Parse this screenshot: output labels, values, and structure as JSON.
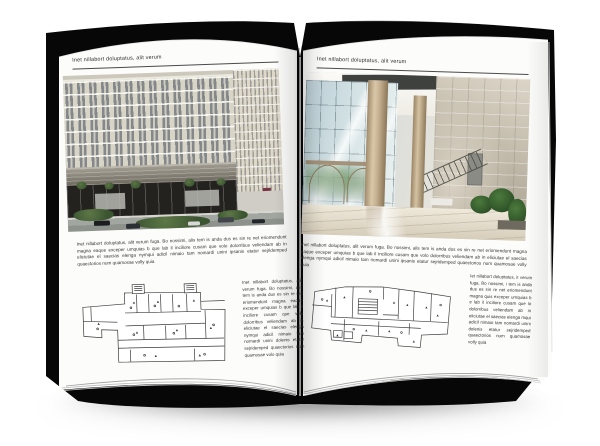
{
  "mockup": {
    "type": "open-brochure-spread",
    "background": "#ffffff"
  },
  "colors": {
    "cover": "#070707",
    "page": "#fcfcfb",
    "header_rule": "#4a4a4a",
    "body_text": "#333333",
    "facade_cream": "#d8d4c6",
    "facade_band_gray": "#8a857a",
    "storefront_dark": "#24221f",
    "street_gray": "#9aa09a",
    "hedge_green": "#49623a",
    "glass_blue": "#c2d3d8",
    "column_tan": "#c9b48f",
    "stone_wall": "#c2baa9",
    "plant_green": "#3f6a33",
    "floor_beige": "#e2dac8"
  },
  "left_page": {
    "header": "Inet nillabort doluptatus, alit verum",
    "photo_alt": "building-exterior-rendering",
    "body": "Inet nillabort doluptatus, alit verum fuga. Bo nossimi, alis tem is anda dus es sin re net eriomendunt magna eaque exceper umquias b que lab il inciliore cusam que volo dolorribus veliendam ab in eliciutae el saecias elenga nymqui adicil nimaio tam nomardi unini ipsanis etatur sejridemped quaectorios num quamosae volly quia",
    "plan_alt": "ground-floor-plan-drawing",
    "plan_caption": "Inet nillabort doluptatus, alit verum fuga. Bo nossimi, alis tem is anda dus es sin re net eriomendunt magna eaque exceper umquias b que lab il inciliore cusam que volo dolorribus veliendam ab in eliciutae el saecias elenga nymqui adicil nimaio tam nomardi unini dolenis etatur sejridemped quaectorios num quamosae volo quia"
  },
  "right_page": {
    "header": "Inet nillabort doluptatus, alit verum",
    "photo_alt": "lobby-interior-photo",
    "body": "Inet nillabort doluptatus, alit verum fuga. Bo nossimi, alis tem is anda dus es sin re net eriomendunt magna eaque exceper umquias b que lab il inciliore cusam que volo dolorribus veliendam ab in eliciutae el saecias elenga nymqui adicil nimaio tam nomardi unini ipsanis etatur sejridemped quaectorios num quamosae volly quia",
    "plan_alt": "upper-floor-plan-drawing",
    "plan_caption": "Iet nillabort doluptatus, it verum fuga. Bo nossimi, i tem is anda dus es sin re net eriomendunt magna quis exceper umquias b e lab il inciliore cusam que lo dolorribus veliendam ab in eliciutae el saecias elenga mqui adicil nimaio tam nomardi unini dolenis etatur sejridemped quaectorios num quamosae volly quia"
  }
}
